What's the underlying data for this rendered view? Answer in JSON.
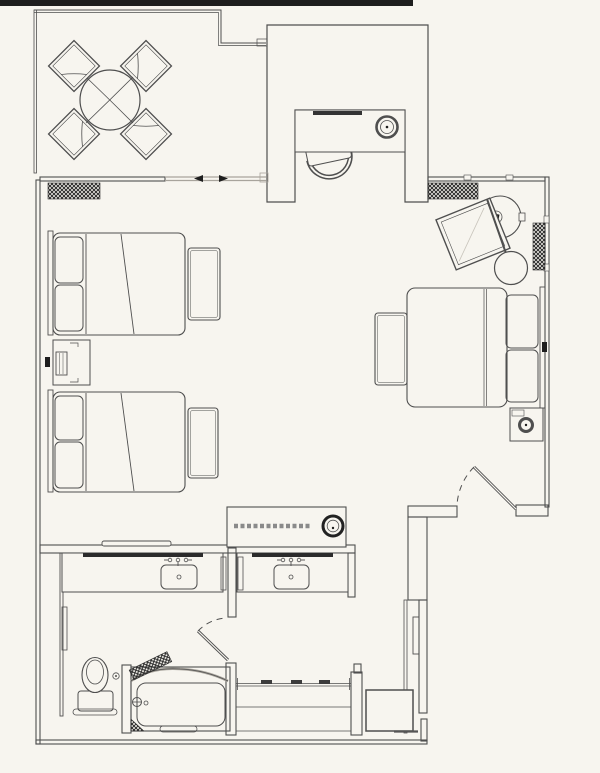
{
  "document": {
    "title": "Hotel guest room floor plan",
    "type": "architectural floor plan",
    "visible_text": []
  },
  "colors": {
    "background": "#f7f5ef",
    "line": "#4f4f4f",
    "line_light": "#a8a49c",
    "dark": "#1e1e1e"
  },
  "areas": [
    {
      "name": "balcony",
      "items": [
        "round-patio-table",
        "patio-chair",
        "patio-chair",
        "patio-chair",
        "patio-chair"
      ]
    },
    {
      "name": "desk-nook",
      "items": [
        "desk",
        "desk-chair",
        "desk-lamp"
      ]
    },
    {
      "name": "bedroom",
      "items": [
        "twin-bed",
        "twin-bed",
        "foot-bench",
        "foot-bench",
        "nightstand",
        "table-lamp",
        "wall-outlet",
        "king-bed",
        "king-foot-bench",
        "king-nightstand",
        "king-table-lamp",
        "wall-outlet",
        "lounge-chair",
        "round-side-table",
        "floor-lamp",
        "media-console",
        "coffee-maker",
        "wall-shelf"
      ]
    },
    {
      "name": "vanity-hall",
      "items": [
        "vanity-counter",
        "sink",
        "mirror",
        "towel-bar",
        "vanity-counter",
        "sink",
        "mirror",
        "towel-bar"
      ]
    },
    {
      "name": "water-closet",
      "items": [
        "toilet",
        "wall-niche",
        "door-stop"
      ]
    },
    {
      "name": "tub-room",
      "items": [
        "bathtub",
        "shower-curtain",
        "grab-bar",
        "shower-valve"
      ]
    },
    {
      "name": "entry-hall",
      "items": [
        "closet-rod",
        "hanger",
        "hanger",
        "hanger",
        "luggage-rack",
        "wall-panel"
      ]
    }
  ],
  "doors": [
    {
      "name": "balcony-sliding-door",
      "type": "sliding"
    },
    {
      "name": "entry-door",
      "type": "swing"
    },
    {
      "name": "bathroom-door",
      "type": "swing"
    }
  ],
  "windows": [
    {
      "name": "drapery-balcony",
      "symbol": "crosshatch"
    },
    {
      "name": "drapery-north",
      "symbol": "crosshatch"
    },
    {
      "name": "drapery-east",
      "symbol": "crosshatch"
    }
  ]
}
